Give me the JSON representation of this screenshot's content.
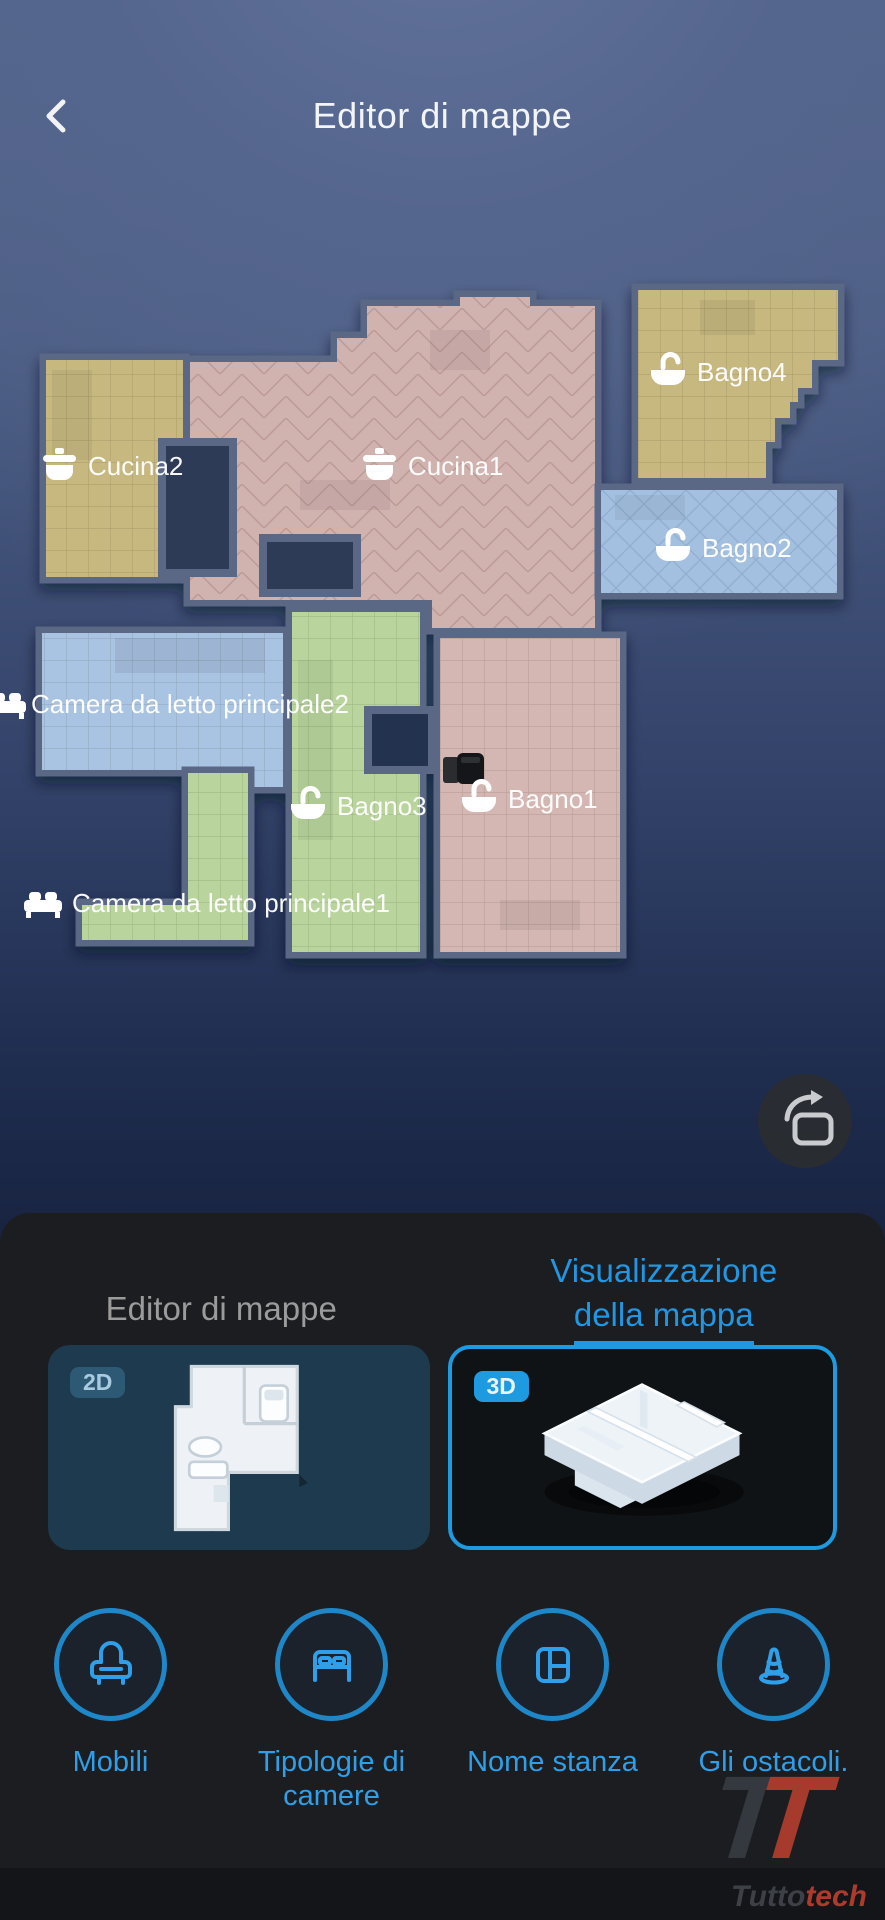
{
  "header": {
    "title": "Editor di mappe",
    "back_icon": "chevron-left"
  },
  "map": {
    "rooms": [
      {
        "id": "cucina2",
        "label": "Cucina2",
        "icon": "pot-icon",
        "color": "#c7b87f"
      },
      {
        "id": "cucina1",
        "label": "Cucina1",
        "icon": "pot-icon",
        "color": "#d0b2ae"
      },
      {
        "id": "bagno4",
        "label": "Bagno4",
        "icon": "bathtub-icon",
        "color": "#c7b87f"
      },
      {
        "id": "bagno2",
        "label": "Bagno2",
        "icon": "bathtub-icon",
        "color": "#a3c0e0"
      },
      {
        "id": "camera2",
        "label": "Camera da letto principale2",
        "icon": "bed-icon",
        "color": "#a9c3e3"
      },
      {
        "id": "bagno3",
        "label": "Bagno3",
        "icon": "bathtub-icon",
        "color": "#b9d49c"
      },
      {
        "id": "bagno1",
        "label": "Bagno1",
        "icon": "bathtub-icon",
        "color": "#d4b6b2"
      },
      {
        "id": "camera1",
        "label": "Camera da letto principale1",
        "icon": "bed-icon",
        "color": "#b9d49c"
      }
    ],
    "robot": {
      "name": "robot-vacuum",
      "room": "Bagno1"
    },
    "wall_color": "#5a6885",
    "rotate_button": "rotate-map"
  },
  "panel": {
    "tab_editor": "Editor di mappe",
    "tab_view_line1": "Visualizzazione",
    "tab_view_line2": "della mappa",
    "cards": [
      {
        "badge": "2D",
        "selected": false
      },
      {
        "badge": "3D",
        "selected": true
      }
    ],
    "tools": [
      {
        "label": "Mobili",
        "icon": "armchair-icon"
      },
      {
        "label": "Tipologie di camere",
        "icon": "double-bed-icon"
      },
      {
        "label": "Nome stanza",
        "icon": "room-layout-icon"
      },
      {
        "label": "Gli ostacoli.",
        "icon": "traffic-cone-icon"
      }
    ],
    "accent_color": "#2e9fe8"
  },
  "watermark": {
    "logo_letter": "T",
    "brand_prefix": "Tutto",
    "brand_suffix": "tech"
  }
}
